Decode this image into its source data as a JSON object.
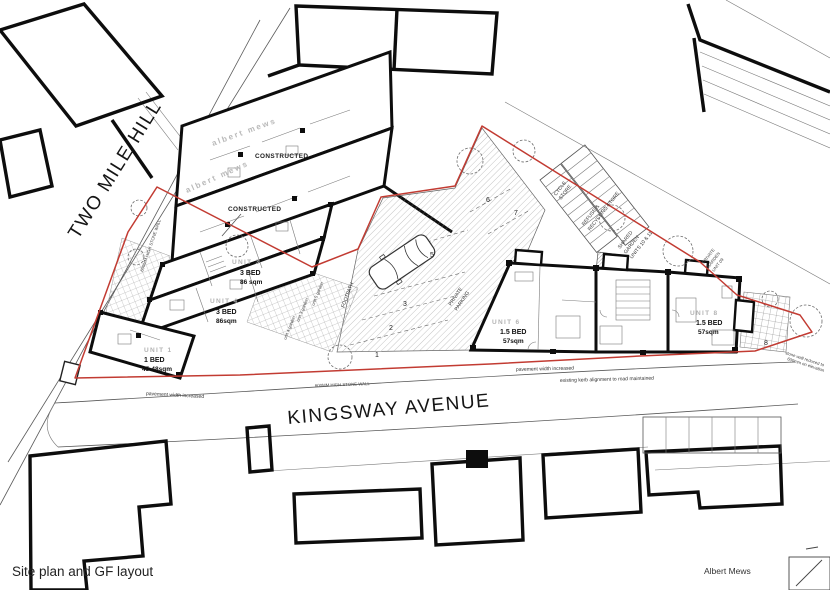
{
  "drawing": {
    "caption": "Site plan and GF layout",
    "project_name": "Albert Mews"
  },
  "roads": {
    "left": "TWO MILE HILL",
    "bottom": "KINGSWAY AVENUE"
  },
  "site_notes": {
    "constructed_a": "CONSTRUCTED",
    "constructed_b": "CONSTRUCTED",
    "ghost_a": "albert mews",
    "ghost_b": "albert mews",
    "pavement_a": "pavement width increased",
    "pavement_b": "pavement width increased",
    "kerb": "existing kerb alignment to road maintained",
    "wall_bottom": "600MM HIGH STONE WALL",
    "wall_left": "600MM HIGH STONE WALL",
    "wall_right_1": "stone wall reduced to",
    "wall_right_2": "600mm on elevation",
    "footpath": "FOOTPATH",
    "parking_1": "PRIVATE",
    "parking_2": "PARKING",
    "cycle_1": "CYCLE",
    "cycle_2": "STORE",
    "refuse_1": "REFUSE &",
    "refuse_2": "RECYCLING STORE",
    "shared_1": "SHARED",
    "shared_2": "GARDEN",
    "shared_3": "UNITS 10 & 11",
    "priv_garden_1": "PRIVATE",
    "priv_garden_2": "GARDEN",
    "priv_garden_3": "UNIT 09",
    "garden_u3": "unit 3 garden",
    "garden_u4": "unit 4 garden",
    "garden_u5": "unit 5 garden"
  },
  "units": [
    {
      "id": "UNIT 1",
      "type": "1 BED",
      "area": "45-48sqm"
    },
    {
      "id": "UNIT 3",
      "type": "3 BED",
      "area": "86 sqm"
    },
    {
      "id": "UNIT 4",
      "type": "3 BED",
      "area": "86sqm"
    },
    {
      "id": "UNIT 6",
      "type": "1.5 BED",
      "area": "57sqm"
    },
    {
      "id": "UNIT 8",
      "type": "1.5 BED",
      "area": "57sqm"
    }
  ],
  "parking_bays": {
    "b1": "1",
    "b2": "2",
    "b3": "3",
    "b5": "5",
    "b6": "6",
    "b7": "7",
    "garden8": "8"
  },
  "colors": {
    "boundary_red": "#c23b32",
    "wall_black": "#0d0d0d",
    "ghost_gray": "#b9b9b9"
  }
}
